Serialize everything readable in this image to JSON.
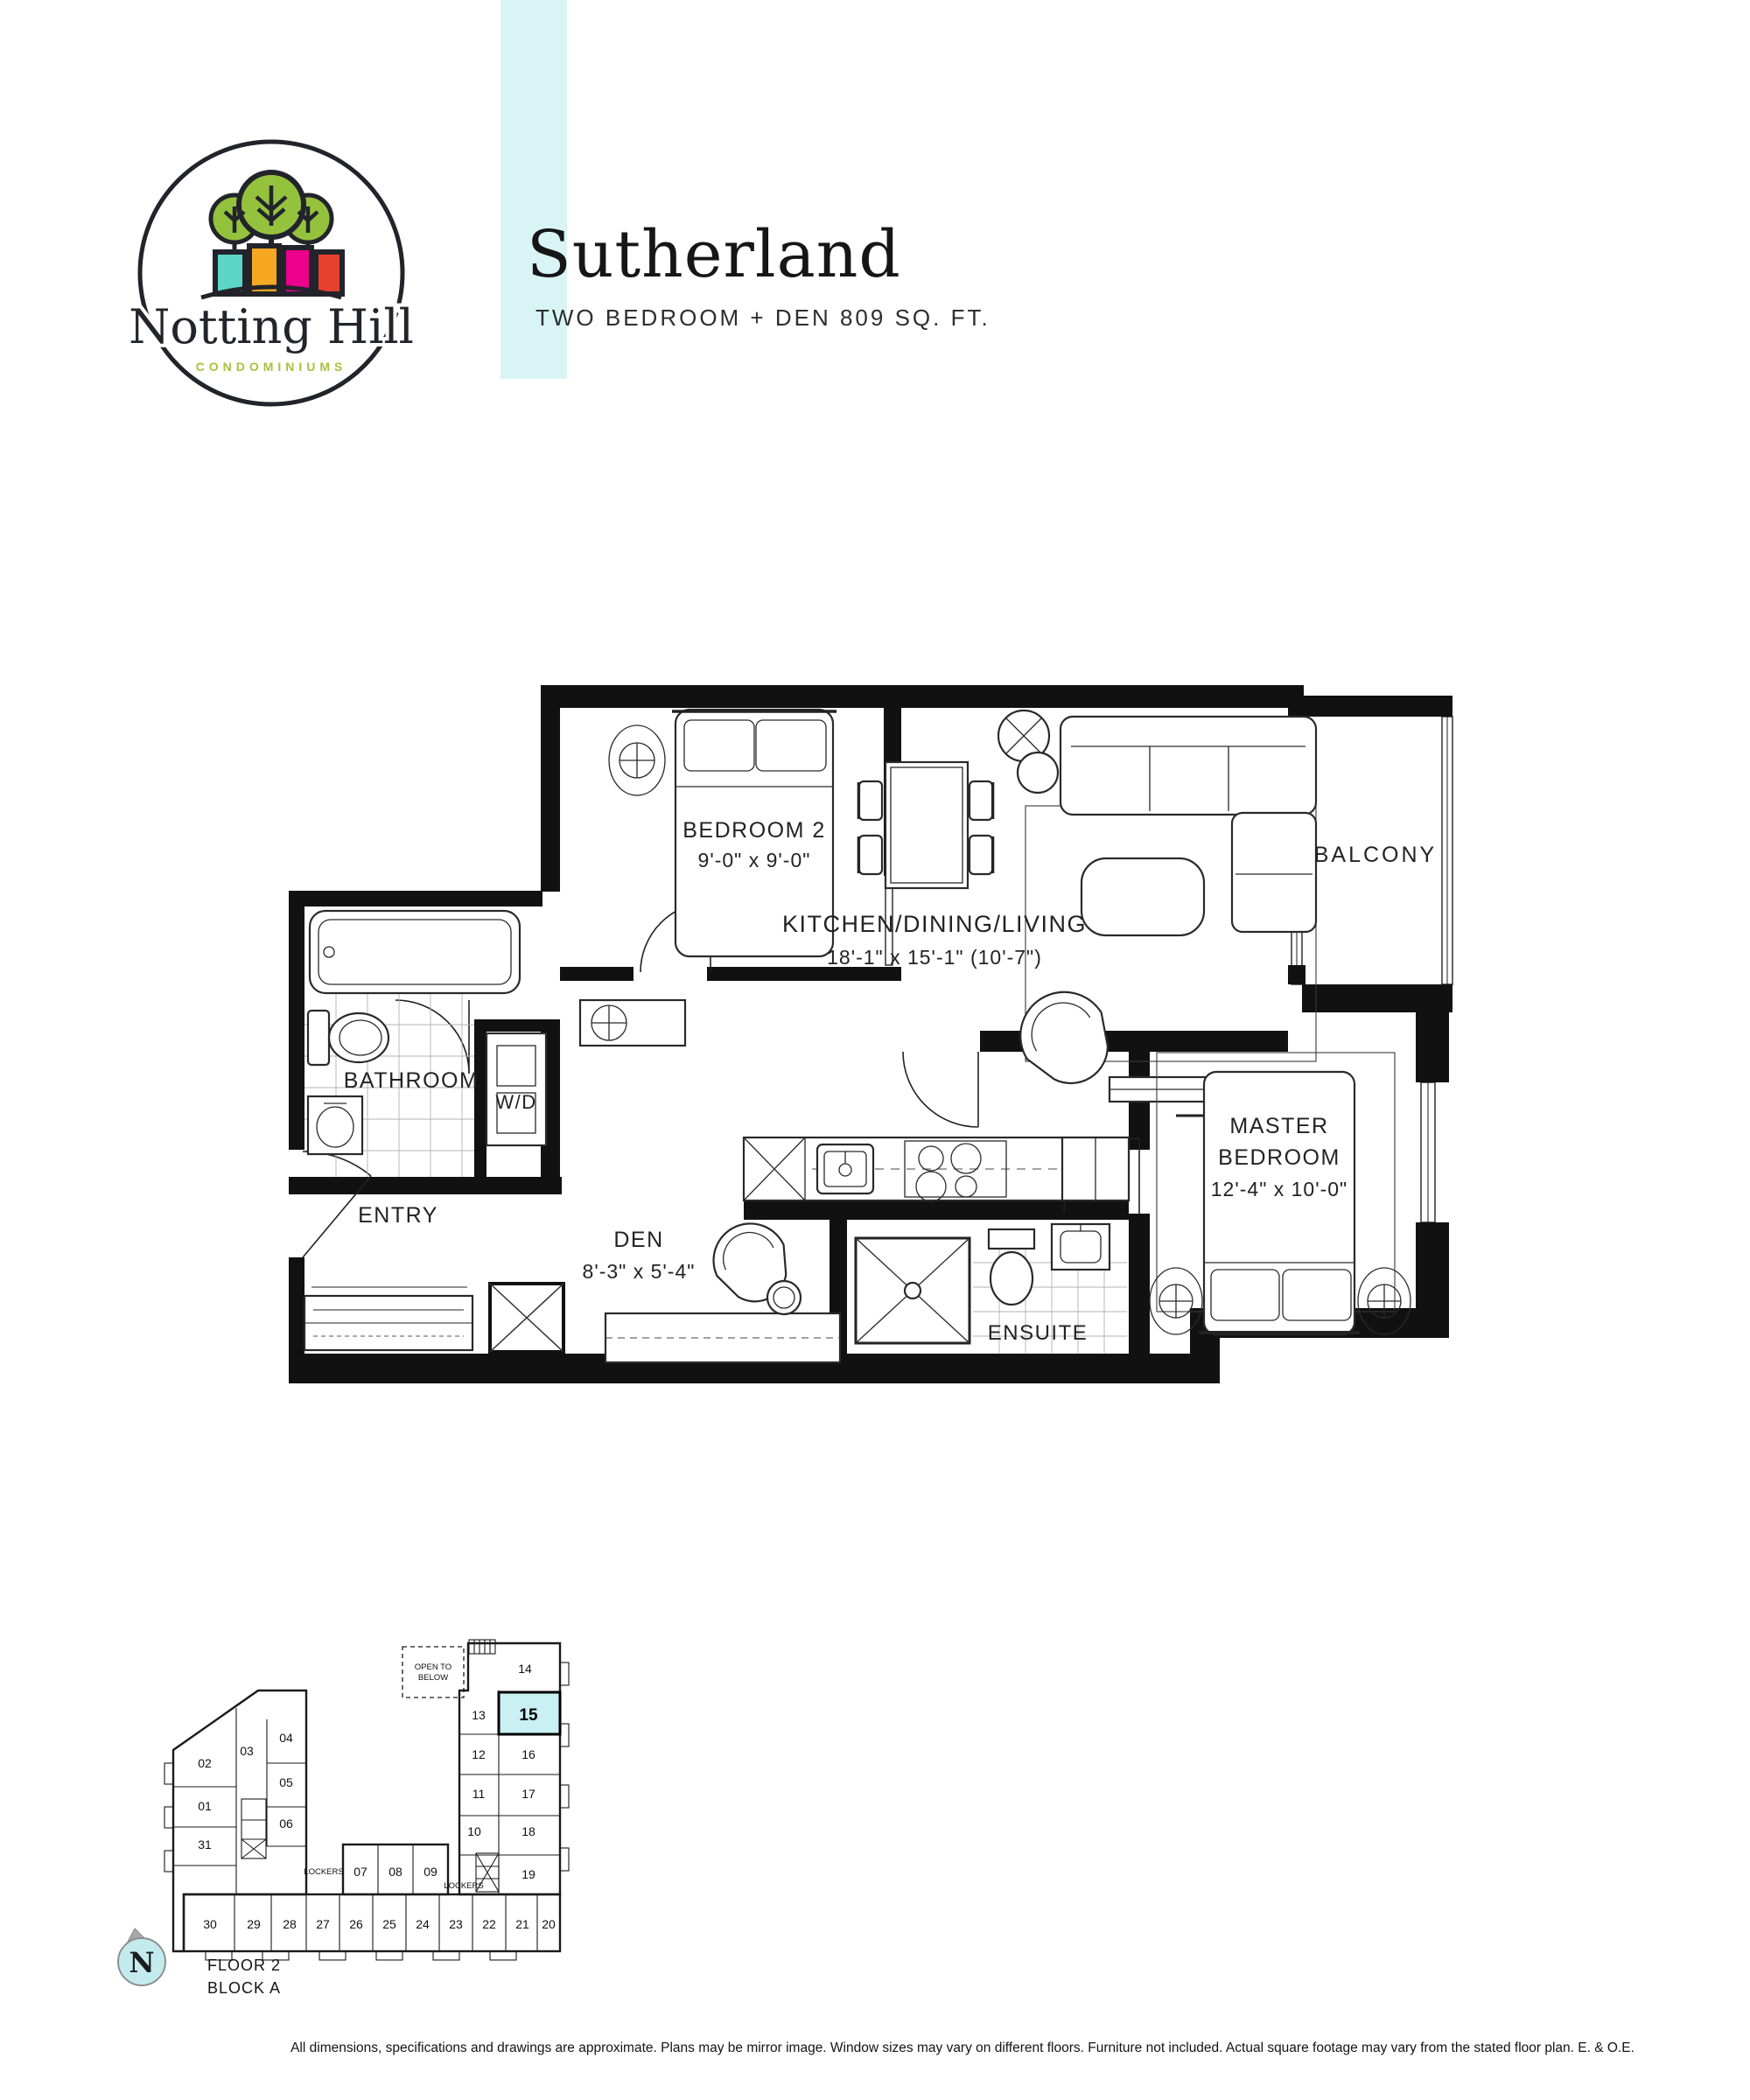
{
  "logo": {
    "name": "Notting Hill",
    "tagline": "CONDOMINIUMS"
  },
  "header": {
    "title": "Sutherland",
    "subtitle": "TWO BEDROOM + DEN 809 SQ. FT."
  },
  "plan": {
    "bedroom2": {
      "name": "BEDROOM 2",
      "dims": "9'-0\" x 9'-0\""
    },
    "kitchen": {
      "name": "KITCHEN/DINING/LIVING",
      "dims": "18'-1\" x 15'-1\" (10'-7\")"
    },
    "bathroom": {
      "name": "BATHROOM"
    },
    "wd": {
      "name": "W/D"
    },
    "entry": {
      "name": "ENTRY"
    },
    "den": {
      "name": "DEN",
      "dims": "8'-3\" x 5'-4\""
    },
    "ensuite": {
      "name": "ENSUITE"
    },
    "master": {
      "line1": "MASTER",
      "line2": "BEDROOM",
      "dims": "12'-4\" x 10'-0\""
    },
    "balcony": {
      "name": "BALCONY"
    }
  },
  "keyplan": {
    "open_to_below_1": "OPEN TO",
    "open_to_below_2": "BELOW",
    "lockers_left": "LOCKERS",
    "lockers_right": "LOCKERS",
    "floor": "FLOOR 2",
    "block": "BLOCK A",
    "north": "N",
    "highlighted_unit": "15",
    "highlight_color": "#c9f0f3",
    "units": [
      "01",
      "02",
      "03",
      "04",
      "05",
      "06",
      "07",
      "08",
      "09",
      "10",
      "11",
      "12",
      "13",
      "14",
      "15",
      "16",
      "17",
      "18",
      "19",
      "20",
      "21",
      "22",
      "23",
      "24",
      "25",
      "26",
      "27",
      "28",
      "29",
      "30",
      "31"
    ]
  },
  "footer": {
    "disclaimer": "All dimensions, specifications and drawings are approximate. Plans may be mirror image. Window sizes may vary on different floors. Furniture not included. Actual square footage may vary from the stated floor plan. E. & O.E."
  },
  "colors": {
    "accent_band": "#d8f4f5",
    "highlight": "#c9f0f3",
    "logo_green": "#a6c33c",
    "logo_teal": "#5bd6c9",
    "logo_orange": "#f7a823",
    "logo_magenta": "#ec008c",
    "logo_red": "#e8402f",
    "ink": "#1c1c1c"
  }
}
